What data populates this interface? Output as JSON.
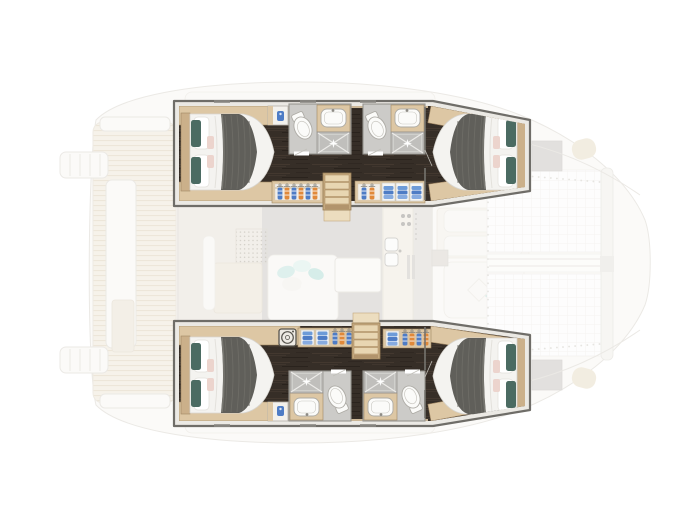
{
  "meta": {
    "artifact": "yacht-floor-plan-illustration",
    "description": "Top-view floor plan of a four-cabin catamaran lower deck drawn sharp over a faded main-deck plan; no visible text labels"
  },
  "colors": {
    "canvas-bg": "#ffffff",
    "hull-outline": "#6f6d68",
    "hull-gunwale": "#ebe9e4",
    "floor-dark": "#362e27",
    "wood-light": "#ddc7a4",
    "wood-mid": "#cbb08a",
    "wood-dark": "#a08663",
    "step-light": "#e8d6b2",
    "mattress": "#f4f3f0",
    "blanket": "#605f5a",
    "pillow-teal": "#4b6b62",
    "pillow-pink": "#ecd4cd",
    "bath-floor": "#cccbc8",
    "bath-wall": "#96948f",
    "shower-tile": "#c0bfbc",
    "fixture-white": "#fbfbf9",
    "clothes-blue": "#4e7cc5",
    "clothes-orange": "#e0893a",
    "washer-outline": "#57544e",
    "faded-line": "#d8d4cc",
    "faded-teak": "#efe7d6",
    "faded-teak-line": "#ddcfb5",
    "salon-floor-grey": "#cac7c3",
    "faded-beige": "#e9e1d1",
    "teal-accent": "#bfe3dd"
  },
  "legend": {
    "cabins": [
      {
        "id": "port-aft-cabin",
        "features": [
          "double-bed",
          "teal-pillows",
          "grey-blanket"
        ]
      },
      {
        "id": "port-forward-cabin",
        "features": [
          "double-bed",
          "teal-pillows",
          "grey-blanket"
        ]
      },
      {
        "id": "starboard-aft-cabin",
        "features": [
          "double-bed",
          "teal-pillows",
          "grey-blanket"
        ]
      },
      {
        "id": "starboard-forward-cabin",
        "features": [
          "double-bed",
          "teal-pillows",
          "grey-blanket"
        ]
      }
    ],
    "bathrooms": [
      {
        "id": "port-aft-bathroom",
        "fixtures": [
          "toilet",
          "sink",
          "shower"
        ]
      },
      {
        "id": "port-forward-bathroom",
        "fixtures": [
          "toilet",
          "sink",
          "shower"
        ]
      },
      {
        "id": "starboard-aft-bathroom",
        "fixtures": [
          "toilet",
          "sink",
          "shower"
        ]
      },
      {
        "id": "starboard-forward-bathroom",
        "fixtures": [
          "toilet",
          "sink",
          "shower"
        ]
      }
    ],
    "storage": [
      "wardrobe-hanging-clothes",
      "shelves-folded-clothes",
      "washing-machine"
    ],
    "circulation": [
      "port-companionway-stairs",
      "starboard-companionway-stairs",
      "port-corridor",
      "starboard-corridor"
    ],
    "faded_main_deck": [
      "aft-cockpit-teak",
      "cockpit-bench",
      "swim-platforms",
      "salon-dinette",
      "galley-with-sink-and-stove",
      "foredeck-lounge",
      "trampoline-nets",
      "forward-crossbeam",
      "deck-hatches"
    ]
  }
}
